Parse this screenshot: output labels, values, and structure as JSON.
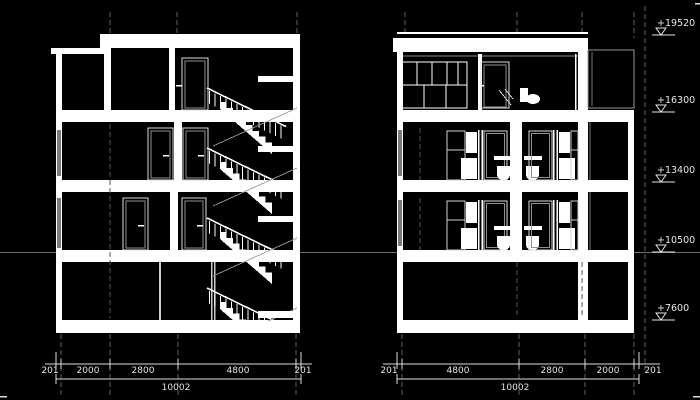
{
  "drawing": {
    "type": "architectural-section-elevations",
    "colors": {
      "background": "#000000",
      "line": "#ffffff",
      "grid": "#777777",
      "level_line": "#6e6e6e"
    },
    "elevation_markers": {
      "labels": [
        "+19520",
        "+16300",
        "+13400",
        "+10500",
        "+7600"
      ]
    },
    "dimensions": {
      "left_section": {
        "segments": [
          "201",
          "2000",
          "2800",
          "4800",
          "201"
        ],
        "total": "10002"
      },
      "right_section": {
        "segments": [
          "201",
          "4800",
          "2800",
          "2000",
          "201"
        ],
        "total": "10002"
      }
    }
  }
}
